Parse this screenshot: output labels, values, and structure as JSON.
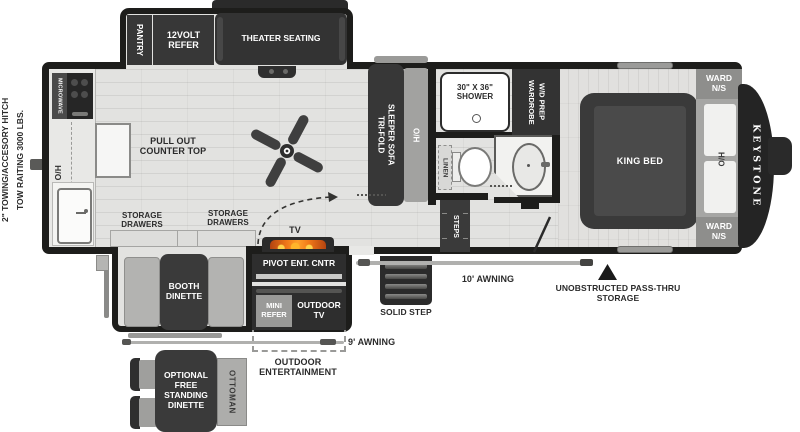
{
  "labels": {
    "hitch_line1": "2\" TOWING/ACCESORY HITCH",
    "hitch_line2": "TOW RAITING 3000 LBS.",
    "pantry": "PANTRY",
    "refer_12v": "12VOLT REFER",
    "theater_seating": "THEATER SEATING",
    "microwave": "MICROWAVE",
    "kitchen_oh": "O/H",
    "pull_out_counter": "PULL OUT COUNTER TOP",
    "storage_drawers_1": "STORAGE DRAWERS",
    "storage_drawers_2": "STORAGE DRAWERS",
    "sofa_line1": "TRI-FOLD",
    "sofa_line2": "SLEEPER SOFA",
    "sofa_oh": "O/H",
    "shower": "30\" X 36\" SHOWER",
    "wardrobe_line1": "WARDROBE",
    "wardrobe_line2": "W/D PREP",
    "linen": "LINEN",
    "steps": "STEPS",
    "king_bed": "KING BED",
    "ward_ns_top": "WARD N/S",
    "ward_ns_bottom": "WARD N/S",
    "bedroom_ho": "H/O",
    "keystone": "KEYSTONE",
    "tv": "TV",
    "pivot_ent": "PIVOT ENT. CNTR",
    "mini_refer": "MINI REFER",
    "outdoor_tv": "OUTDOOR TV",
    "booth_dinette": "BOOTH DINETTE",
    "awning_10": "10' AWNING",
    "awning_9": "9' AWNING",
    "solid_step": "SOLID STEP",
    "pass_thru": "UNOBSTRUCTED PASS-THRU STORAGE",
    "outdoor_entertainment": "OUTDOOR ENTERTAINMENT",
    "optional_dinette": "OPTIONAL FREE STANDING DINETTE",
    "ottoman": "OTTOMAN"
  },
  "colors": {
    "wall": "#1d1d1b",
    "floor": "#e2e2e0",
    "dark_furniture": "#373737",
    "gray_furniture": "#a8a8a6",
    "flame_orange": "#f07818",
    "text_dark": "#2b2b2b"
  }
}
